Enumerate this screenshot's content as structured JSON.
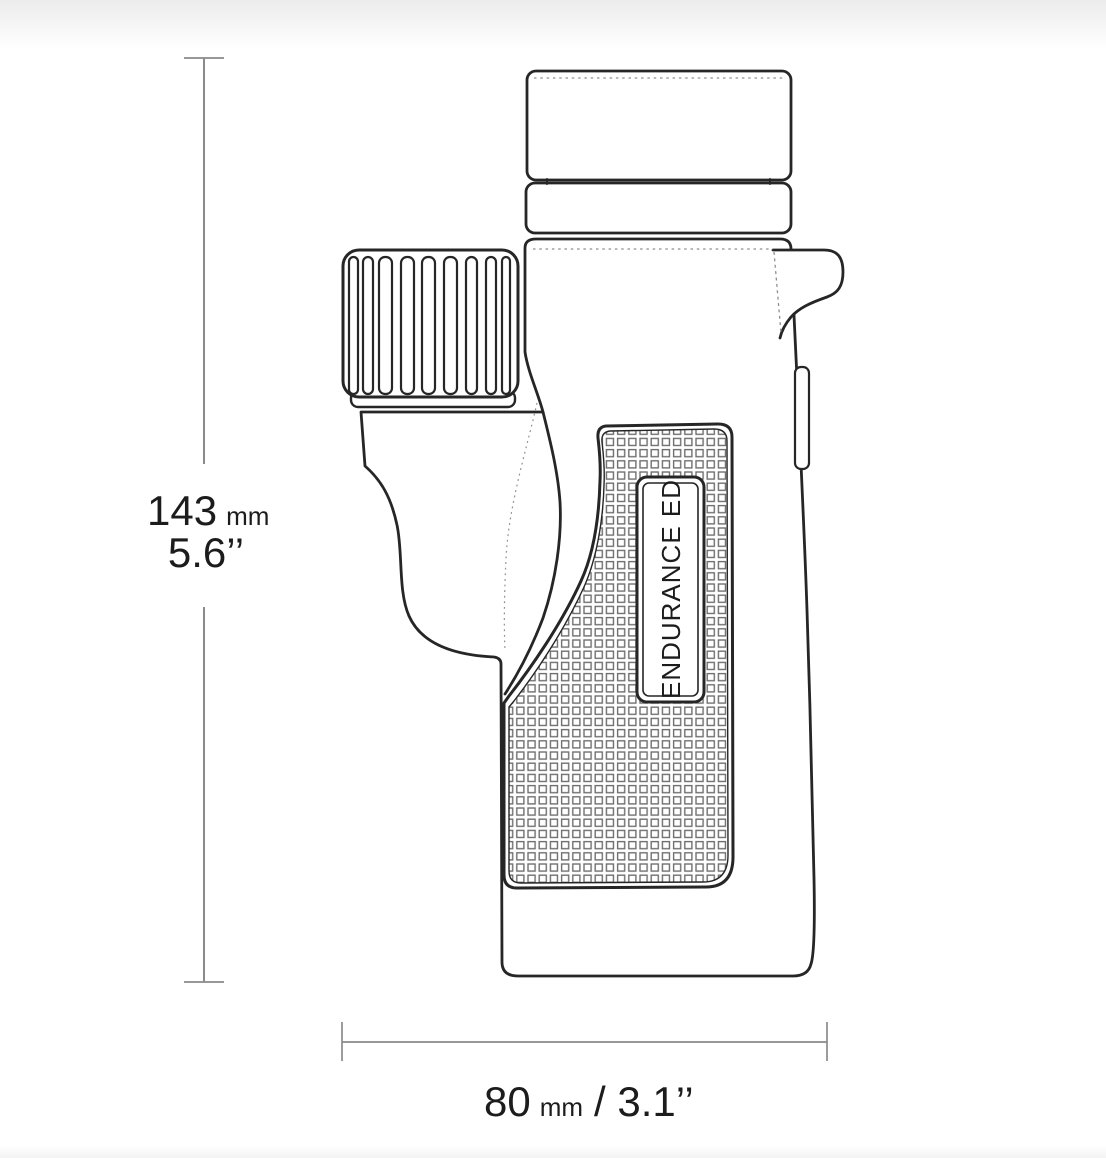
{
  "product": {
    "badge_label": "ENDURANCE ED"
  },
  "dimensions": {
    "height": {
      "value": "143",
      "unit": "mm",
      "inches": "5.6’’"
    },
    "width": {
      "value": "80",
      "unit": "mm",
      "inches": "/ 3.1’’"
    }
  },
  "colors": {
    "outline": "#262626",
    "hidden_line": "#8f8f8f",
    "dimension_line": "#8a8a8a",
    "label_text": "#1c1c1c",
    "texture": "#6f6f6f"
  }
}
